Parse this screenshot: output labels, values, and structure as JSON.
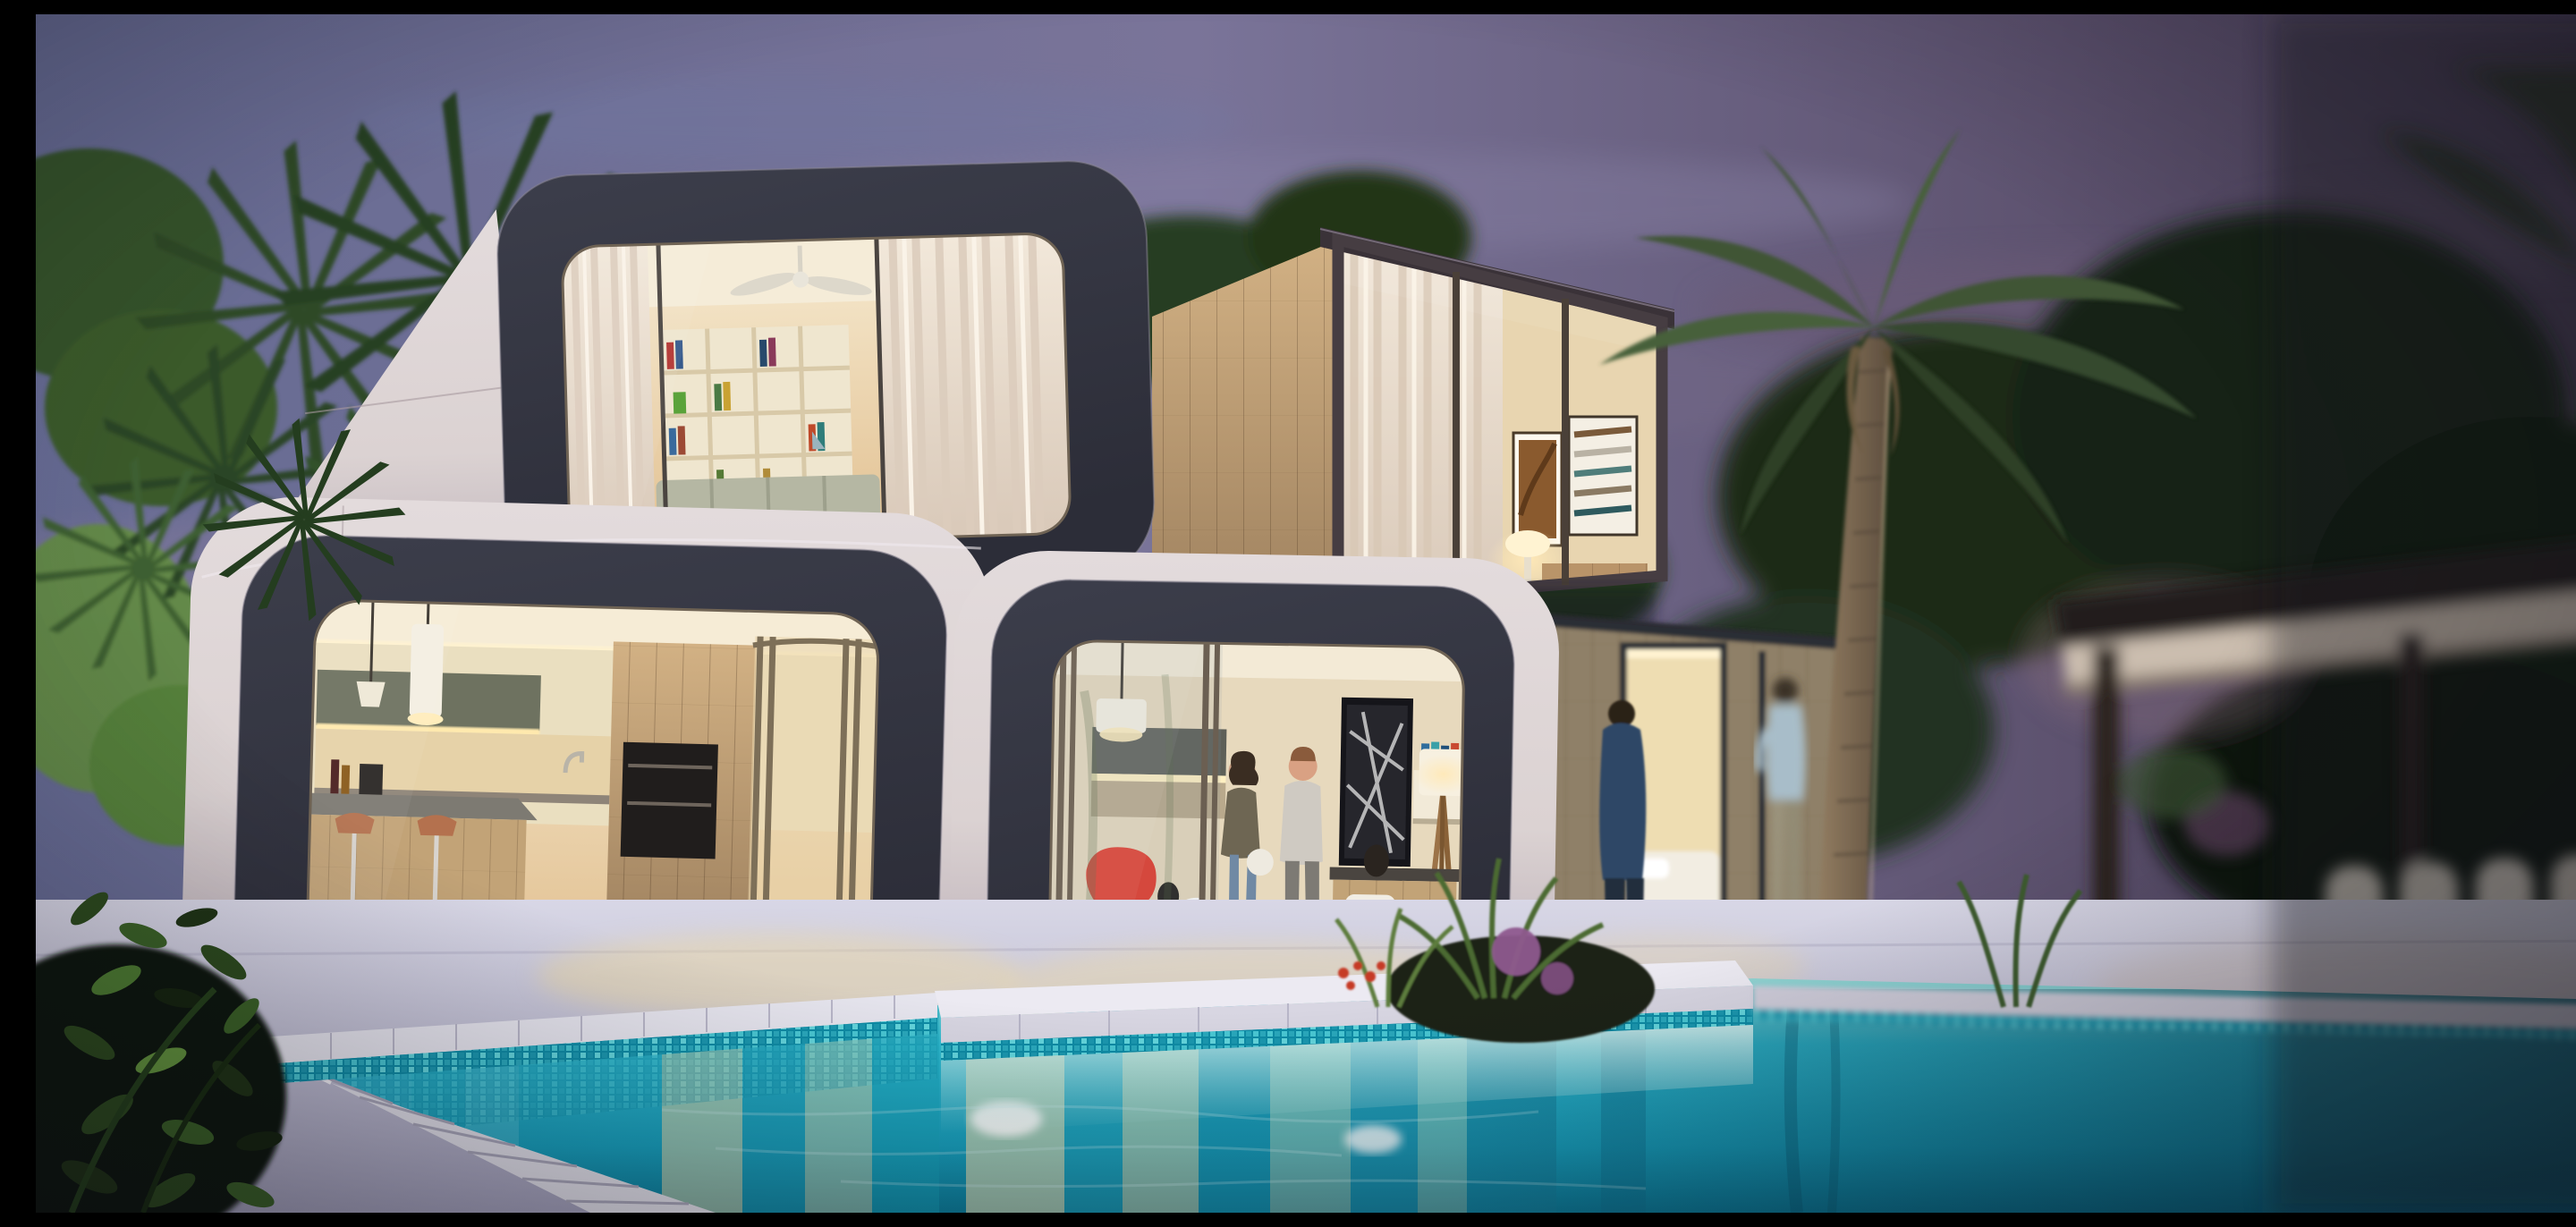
{
  "scene": {
    "title": "Modern modular cube house with swimming pool at dusk",
    "time_of_day": "dusk",
    "style": "photorealistic architectural render with tilt-shift blur",
    "objects": [
      "purple dusk sky with pink clouds",
      "dark tropical palm trees on the left",
      "stacked prefab pods with rounded dark frames and cream shells",
      "bedroom pod with white curtains, ceiling fan and cubby bookshelf",
      "kitchen pod with wood cabinets, island, copper bar stools and pendant lights",
      "living room pod with two people, red chair, ottoman, artwork and tripod lamp",
      "angled guest pod with sheer curtains, framed art and glowing table lamp",
      "wood-clad module with open door and bed",
      "tall palm tree in front of the house",
      "two men talking on the terrace",
      "blurred pergola with white chairs on the right",
      "white stone deck and stepped pool coping",
      "turquoise mosaic-tiled swimming pool with warm window reflections",
      "dark leafy plants in the near foreground"
    ]
  },
  "palette": {
    "sky-left": "#666b93",
    "sky-mid": "#7a7499",
    "sky-right": "#463c52",
    "cloud-pink": "#a57e92",
    "foliage-dark": "#1d2c18",
    "foliage-mid": "#35522c",
    "foliage-light": "#628c41",
    "palm-frond": "#3f5536",
    "trunk-brown": "#84715c",
    "frame-dark": "#2c2d38",
    "frame-dark-2": "#3c3e4b",
    "shell-light": "#dbd2d2",
    "shell-shadow": "#b3a7b1",
    "interior-warm": "#f6ead0",
    "interior-deep": "#e2c192",
    "wood-light": "#c9a877",
    "wood-dark": "#9c7f5d",
    "olive-cabinet": "#6e7260",
    "bronze-frame": "#8a7a63",
    "curtain-cream": "#f2e8da",
    "red-accent": "#e23c2d",
    "pool-teal": "#2fb9cf",
    "pool-deep": "#0b7b98",
    "mosaic-teal": "#35c2cf",
    "coping-white": "#e2e1ea",
    "deck-lavender": "#c6c5d8",
    "warm-reflection": "#ecd9a6",
    "lamp-glow": "#ffe9b8",
    "night-shadow": "#16131d"
  }
}
